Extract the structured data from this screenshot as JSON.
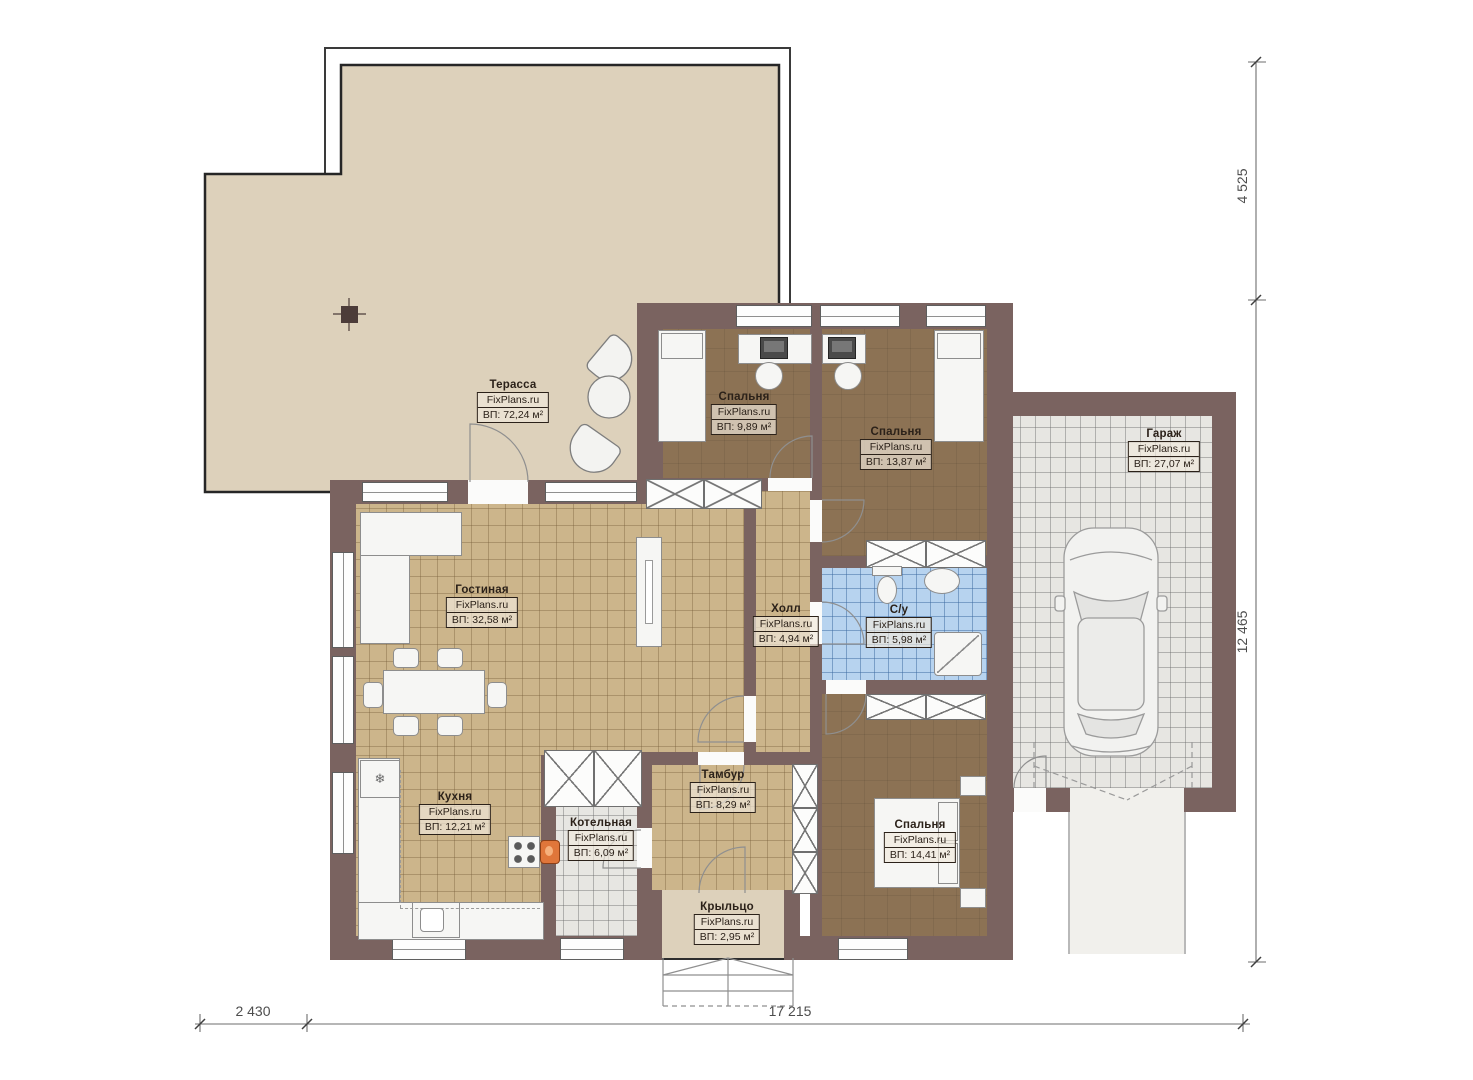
{
  "site_label": "FixPlans.ru",
  "rooms": [
    {
      "name": "Терасса",
      "area": "ВП: 72,24 м²"
    },
    {
      "name": "Спальня",
      "area": "ВП: 9,89 м²"
    },
    {
      "name": "Спальня",
      "area": "ВП: 13,87 м²"
    },
    {
      "name": "Гараж",
      "area": "ВП: 27,07 м²"
    },
    {
      "name": "Гостиная",
      "area": "ВП: 32,58 м²"
    },
    {
      "name": "Холл",
      "area": "ВП: 4,94 м²"
    },
    {
      "name": "С/у",
      "area": "ВП: 5,98 м²"
    },
    {
      "name": "Кухня",
      "area": "ВП: 12,21 м²"
    },
    {
      "name": "Котельная",
      "area": "ВП: 6,09 м²"
    },
    {
      "name": "Тамбур",
      "area": "ВП: 8,29 м²"
    },
    {
      "name": "Спальня",
      "area": "ВП: 14,41 м²"
    },
    {
      "name": "Крыльцо",
      "area": "ВП: 2,95 м²"
    }
  ],
  "dimensions": {
    "top_right_vertical": "4 525",
    "right_vertical": "12 465",
    "bottom_left": "2 430",
    "bottom_main": "17 215"
  },
  "icons": {
    "fridge": "❄"
  },
  "colors": {
    "wall": "#7a6360",
    "terrace_floor": "#ddd1bb",
    "wood_tile_floor": "#ccb58b",
    "bedroom_floor": "#8c7254",
    "garage_floor": "#e7e6e2",
    "bath_tile": "#b7d3ef",
    "boiler_accent": "#e0763a"
  }
}
